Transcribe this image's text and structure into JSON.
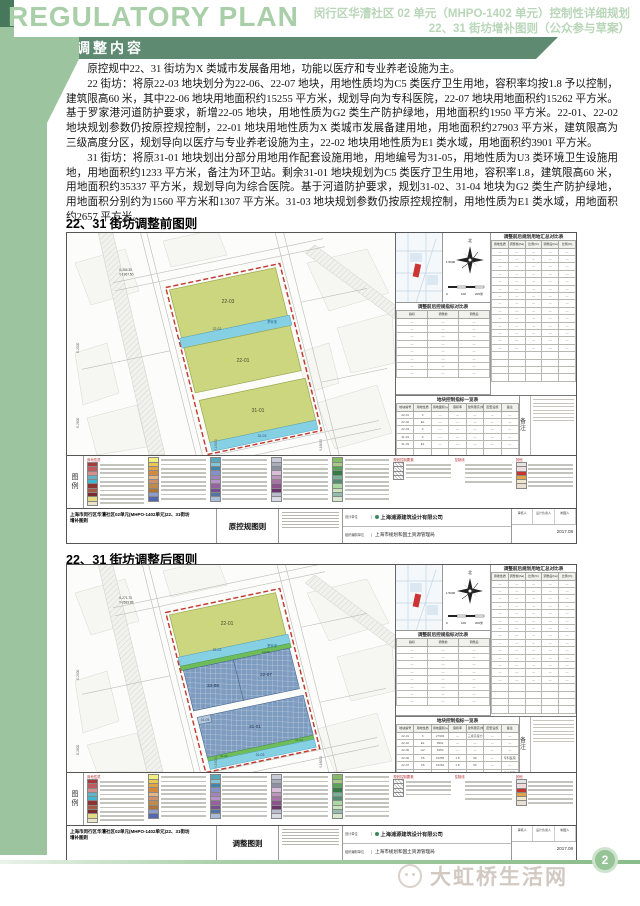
{
  "header": {
    "title_en": "REGULATORY PLAN",
    "subtitle_line1": "闵行区华漕社区 02 单元（MHPO-1402 单元）控制性详细规划",
    "subtitle_line2": "22、31 街坊增补图则（公众参与草案）",
    "banner": "调整内容"
  },
  "content": {
    "p1": "原控规中22、31 街坊为X 类城市发展备用地，功能以医疗和专业养老设施为主。",
    "p2": "22 街坊：将原22-03 地块划分为22-06、22-07 地块，用地性质均为C5 类医疗卫生用地，容积率均按1.8 予以控制，建筑限高60 米，其中22-06 地块用地面积约15255 平方米，规划导向为专科医院，22-07 地块用地面积约15262 平方米。基于罗家港河道防护要求，新增22-05 地块，用地性质为G2 类生产防护绿地，用地面积约1950 平方米。22-01、22-02 地块规划参数仍按原控规控制，22-01 地块用地性质为X 类城市发展备建用地，用地面积约27903 平方米，建筑限高为三级高度分区，规划导向以医疗与专业养老设施为主，22-02 地块用地性质为E1 类水域，用地面积约3901 平方米。",
    "p3": "31 街坊：将原31-01 地块划出分部分用地用作配套设施用地，用地编号为31-05，用地性质为U3 类环境卫生设施用地，用地面积约1233 平方米，备注为环卫站。剩余31-01 地块规划为C5 类医疗卫生用地，容积率1.8，建筑限高60 米，用地面积约35337 平方米，规划导向为综合医院。基于河道防护要求，规划31-02、31-04 地块为G2 类生产防护绿地，用地面积分别约为1560 平方米和1307 平方米。31-03 地块规划参数仍按原控规控制，用地性质为E1 类水域，用地面积约2657 平方米。"
  },
  "sections": {
    "before_heading": "22、31 街坊调整前图则",
    "after_heading": "22、31 街坊调整后图则"
  },
  "colors": {
    "parcel_yellow": "#ccd67e",
    "water": "#86d0e4",
    "green_strip": "#6fbc5a",
    "hospital_blue": "#7e9cc0",
    "boundary": "#c03a30"
  },
  "map_common": {
    "river_name": "罗家港",
    "compass": {
      "north": "北",
      "scale": "1:5000",
      "bar0": "0",
      "bar1": "100",
      "bar2": "200米"
    },
    "notes_label": "备注",
    "legend": {
      "label": "图例",
      "columns": [
        {
          "header": "用地性质",
          "items": [
            "#a8393d",
            "#c05a5e",
            "#d4908f",
            "#5fb4c8",
            "#3fb6d2",
            "#8c3434",
            "#a85a43",
            "#7c2a30",
            "#e4da84",
            "#ece4c8"
          ]
        },
        {
          "header": "",
          "items": [
            "#f2ee7e",
            "#edc84e",
            "#e2a344",
            "#d5893d",
            "#e3b685",
            "#cf8f6a",
            "#c08a4a",
            "#ad7634",
            "#8f9cc8",
            "#5468b0"
          ]
        },
        {
          "header": "",
          "items": [
            "#58a8bc",
            "#84c4d4",
            "#4484aa",
            "#8490c6",
            "#a284bc",
            "#b894cc",
            "#94629e",
            "#74508e",
            "#5474a4",
            "#a8bcd8"
          ]
        },
        {
          "header": "",
          "items": [
            "#c8ccd8",
            "#a8acbc",
            "#8c90a0",
            "#d8bcd8",
            "#bc94bc",
            "#a874a8",
            "#8c548c",
            "#6c346c",
            "#b8bccc",
            "#d8dce4"
          ]
        },
        {
          "header": "",
          "items": [
            "#84bc64",
            "#a4cc84",
            "#54a454",
            "#347c44",
            "#74b494",
            "#548c74",
            "#acd8a4",
            "#cce4bc",
            "#94bcac",
            "#d8e8cc"
          ]
        },
        {
          "header": "规划控制要素",
          "items": [
            "hatch",
            "hatch",
            "hatch",
            "hatch"
          ]
        },
        {
          "header": "控制线",
          "items": [
            "line:#c0392b:solid",
            "line:#2e8b57:solid",
            "line:#2456a8:solid",
            "line:#333333:dashed",
            "line:#777777:dotted"
          ]
        },
        {
          "header": "其他",
          "items": [
            "#e4e4e4",
            "#f0dcdc",
            "#c8342c",
            "#e2a344",
            "#efe8cc",
            "#e8e0d0"
          ]
        }
      ]
    },
    "tables": {
      "summary": {
        "title": "调整前后规划用地汇总对比表",
        "headers": [
          "用地性质",
          "调整前(ha)",
          "比例(%)",
          "调整后(ha)",
          "比例(%)"
        ],
        "rows": [
          [
            "—",
            "—",
            "—",
            "—",
            "—"
          ],
          [
            "—",
            "—",
            "—",
            "—",
            "—"
          ],
          [
            "—",
            "—",
            "—",
            "—",
            "—"
          ],
          [
            "—",
            "—",
            "—",
            "—",
            "—"
          ],
          [
            "—",
            "—",
            "—",
            "—",
            "—"
          ],
          [
            "—",
            "—",
            "—",
            "—",
            "—"
          ],
          [
            "—",
            "—",
            "—",
            "—",
            "—"
          ],
          [
            "—",
            "—",
            "—",
            "—",
            "—"
          ],
          [
            "—",
            "—",
            "—",
            "—",
            "—"
          ],
          [
            "—",
            "—",
            "—",
            "—",
            "—"
          ],
          [
            "—",
            "—",
            "—",
            "—",
            "—"
          ],
          [
            "—",
            "—",
            "—",
            "—",
            "—"
          ],
          [
            "—",
            "—",
            "—",
            "—",
            "—"
          ],
          [
            "—",
            "—",
            "—",
            "—",
            "—"
          ],
          [
            "",
            "",
            "",
            "",
            ""
          ],
          [
            "",
            "",
            "",
            "",
            ""
          ],
          [
            "",
            "",
            "",
            "",
            ""
          ],
          [
            "",
            "",
            "",
            "",
            ""
          ]
        ]
      },
      "compare": {
        "title": "调整前后控规指标对比表",
        "headers": [
          "指标",
          "调整前",
          "调整后"
        ],
        "rows": [
          [
            "—",
            "—",
            "—"
          ],
          [
            "—",
            "—",
            "—"
          ],
          [
            "—",
            "—",
            "—"
          ],
          [
            "—",
            "—",
            "—"
          ],
          [
            "—",
            "—",
            "—"
          ],
          [
            "—",
            "—",
            "—"
          ],
          [
            "—",
            "—",
            "—"
          ],
          [
            "—",
            "—",
            "—"
          ]
        ]
      }
    },
    "titleblock": {
      "project_line1": "上海市闵行区华漕社区02单元(MHPO-1402单元)22、31街坊",
      "project_line2": "增补图则",
      "design_label": "设计单位",
      "design_firm": "上海浦源建筑设计有限公司",
      "org_label": "组织编制单位",
      "org_name": "上海市规划和国土资源管理局",
      "roles": [
        "审核人",
        "设计负责人",
        "制图人"
      ],
      "date": "2017.08"
    }
  },
  "map1": {
    "sheet_name": "原控规图则",
    "parcels": {
      "a": "22-03",
      "b": "22-02",
      "c": "22-01",
      "d": "31-01",
      "e": "31-03"
    },
    "coords": {
      "c1": "X-264.35",
      "c2": "Y-1967.50"
    },
    "ticks": {
      "left1": "E-2500",
      "left2": "E-2600",
      "bottom1": "Y-15000",
      "bottom2": "Y-16000"
    },
    "detail_table": {
      "title": "地块控制指标一览表",
      "headers": [
        "地块编号",
        "用地性质",
        "用地面积(㎡)",
        "容积率",
        "建筑限高(米)",
        "配套设施",
        "备注"
      ],
      "rows": [
        [
          "22-01",
          "X",
          "—",
          "—",
          "—",
          "—",
          "—"
        ],
        [
          "22-02",
          "E1",
          "—",
          "—",
          "—",
          "—",
          "—"
        ],
        [
          "22-03",
          "X",
          "—",
          "—",
          "—",
          "—",
          "—"
        ],
        [
          "31-01",
          "X",
          "—",
          "—",
          "—",
          "—",
          "—"
        ],
        [
          "31-03",
          "E1",
          "—",
          "—",
          "—",
          "—",
          "—"
        ],
        [
          "",
          "",
          "",
          "",
          "",
          "",
          ""
        ],
        [
          "",
          "",
          "",
          "",
          "",
          "",
          ""
        ]
      ]
    }
  },
  "map2": {
    "sheet_name": "调整图则",
    "parcels": {
      "a": "22-01",
      "b": "22-02",
      "g": "22-05",
      "h": "22-06",
      "i": "22-07",
      "d": "31-01",
      "j": "31-05",
      "k": "31-02",
      "l": "31-04",
      "e": "31-03"
    },
    "coords": {
      "c1": "X-271.70",
      "c2": "Y-2683.89"
    },
    "ticks": {
      "left1": "E-2500",
      "left2": "E-2600",
      "bottom1": "Y-15000",
      "bottom2": "Y-16000"
    },
    "detail_table": {
      "title": "地块控制指标一览表",
      "headers": [
        "地块编号",
        "用地性质",
        "用地面积(㎡)",
        "容积率",
        "建筑限高(米)",
        "配套设施",
        "备注"
      ],
      "rows": [
        [
          "22-01",
          "X",
          "27903",
          "—",
          "三级高度分区",
          "—",
          "—"
        ],
        [
          "22-02",
          "E1",
          "3901",
          "—",
          "—",
          "—",
          "—"
        ],
        [
          "22-05",
          "G2",
          "1950",
          "—",
          "—",
          "—",
          "—"
        ],
        [
          "22-06",
          "C5",
          "15255",
          "1.8",
          "60",
          "—",
          "专科医院"
        ],
        [
          "22-07",
          "C5",
          "15262",
          "1.8",
          "60",
          "—",
          "—"
        ],
        [
          "31-01",
          "C5",
          "35337",
          "1.8",
          "60",
          "—",
          "综合医院"
        ],
        [
          "31-02",
          "G2",
          "1560",
          "—",
          "—",
          "—",
          "—"
        ],
        [
          "31-03",
          "E1",
          "2657",
          "—",
          "—",
          "—",
          "—"
        ],
        [
          "31-04",
          "G2",
          "1307",
          "—",
          "—",
          "—",
          "—"
        ],
        [
          "31-05",
          "U3",
          "1233",
          "—",
          "—",
          "—",
          "环卫站"
        ]
      ]
    }
  },
  "footer": {
    "page_number": "2",
    "watermark": "大虹桥生活网"
  }
}
